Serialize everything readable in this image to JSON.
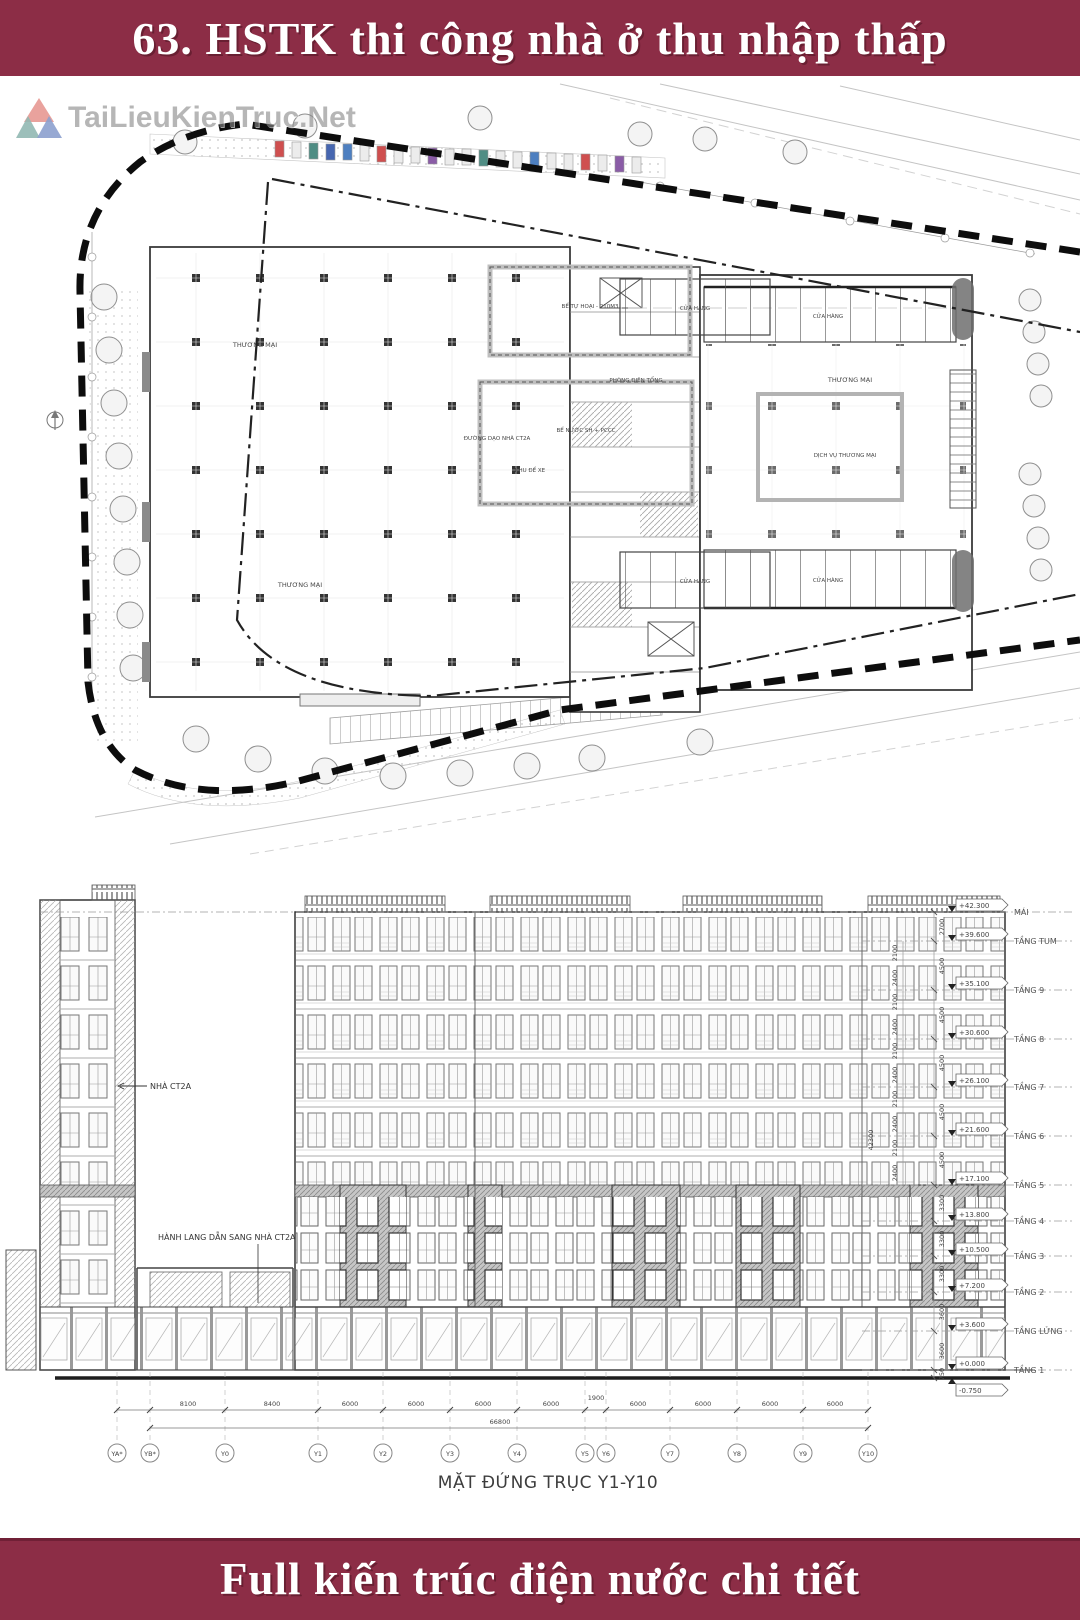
{
  "header": {
    "title": "63. HSTK thi công nhà ở thu nhập thấp",
    "bg_color": "#8c2d46",
    "text_color": "#ffffff"
  },
  "footer": {
    "title": "Full kiến trúc điện nước chi tiết",
    "bg_color": "#8c2d46",
    "text_color": "#ffffff"
  },
  "watermark": {
    "text": "TaiLieuKienTruc.Net",
    "logo_colors": {
      "red": "#d85a50",
      "teal": "#4f8d84",
      "blue": "#4666b0"
    }
  },
  "plan": {
    "type": "ground floor site plan",
    "labels": {
      "thuong_mai": "THƯƠNG MẠI",
      "cua_hang": "CỬA HÀNG",
      "khu_de_xe": "KHU ĐỂ XE",
      "dich_vu": "DỊCH VỤ THƯƠNG MẠI",
      "be_tu_hoai": "BỂ TỰ HOẠI - 210M3",
      "be_nuoc": "BỂ NƯỚC SH + PCCC",
      "phong_dien": "PHÒNG ĐIỆN TỔNG",
      "duong_dao": "ĐƯỜNG DẠO NHÀ CT2A"
    },
    "car_colors": [
      "#cf4f4f",
      "#4f8d84",
      "#4666b0",
      "#4d7fc0",
      "#8a5ca6"
    ]
  },
  "elevation": {
    "caption": "MẶT ĐỨNG TRỤC Y1-Y10",
    "tower_label": "NHÀ CT2A",
    "corridor_label": "HÀNH LANG DẪN SANG NHÀ CT2A",
    "overall_dim": "42300",
    "sub_dims": {
      "upper": "2100",
      "lower": "2400"
    },
    "floor_dims": [
      "2700",
      "4500",
      "4500",
      "4500",
      "4500",
      "4500",
      "3300",
      "3300",
      "3300",
      "3600",
      "3600",
      "750"
    ],
    "levels": [
      {
        "name": "MÁI",
        "elev": "+42.300"
      },
      {
        "name": "TẦNG TUM",
        "elev": "+39.600"
      },
      {
        "name": "TẦNG 9",
        "elev": "+35.100"
      },
      {
        "name": "TẦNG 8",
        "elev": "+30.600"
      },
      {
        "name": "TẦNG 7",
        "elev": "+26.100"
      },
      {
        "name": "TẦNG 6",
        "elev": "+21.600"
      },
      {
        "name": "TẦNG 5",
        "elev": "+17.100"
      },
      {
        "name": "TẦNG 4",
        "elev": "+13.800"
      },
      {
        "name": "TẦNG 3",
        "elev": "+10.500"
      },
      {
        "name": "TẦNG 2",
        "elev": "+7.200"
      },
      {
        "name": "TẦNG LỬNG",
        "elev": "+3.600"
      },
      {
        "name": "TẦNG 1",
        "elev": "+0.000"
      },
      {
        "name": "",
        "elev": "-0.750"
      }
    ],
    "axis": {
      "bubbles": [
        "YA*",
        "YB*",
        "Y0",
        "Y1",
        "Y2",
        "Y3",
        "Y4",
        "Y5",
        "Y6",
        "Y7",
        "Y8",
        "Y9",
        "Y10"
      ],
      "dims": [
        "8100",
        "8400",
        "6000",
        "6000",
        "6000",
        "6000",
        "1900",
        "6000",
        "6000",
        "6000",
        "6000"
      ],
      "overall": "66800"
    }
  }
}
